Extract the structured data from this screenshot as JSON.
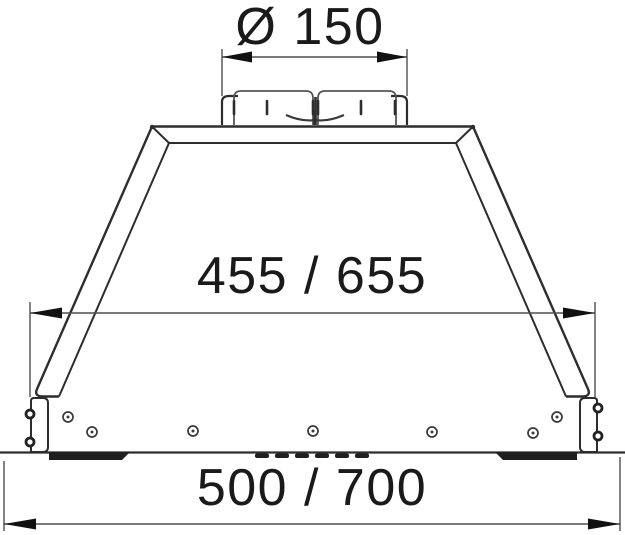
{
  "drawing": {
    "kind": "cooker-hood-dimension-drawing",
    "dimensions": {
      "duct_diameter": {
        "label": "Ø 150"
      },
      "body_width": {
        "label": "455 / 655"
      },
      "overall_width": {
        "label": "500 / 700"
      }
    },
    "colors": {
      "background": "#ffffff",
      "outline": "#2d2d2d",
      "dimension_line": "#4f4f4f",
      "arrow": "#111111",
      "text": "#1a1a1a"
    }
  }
}
